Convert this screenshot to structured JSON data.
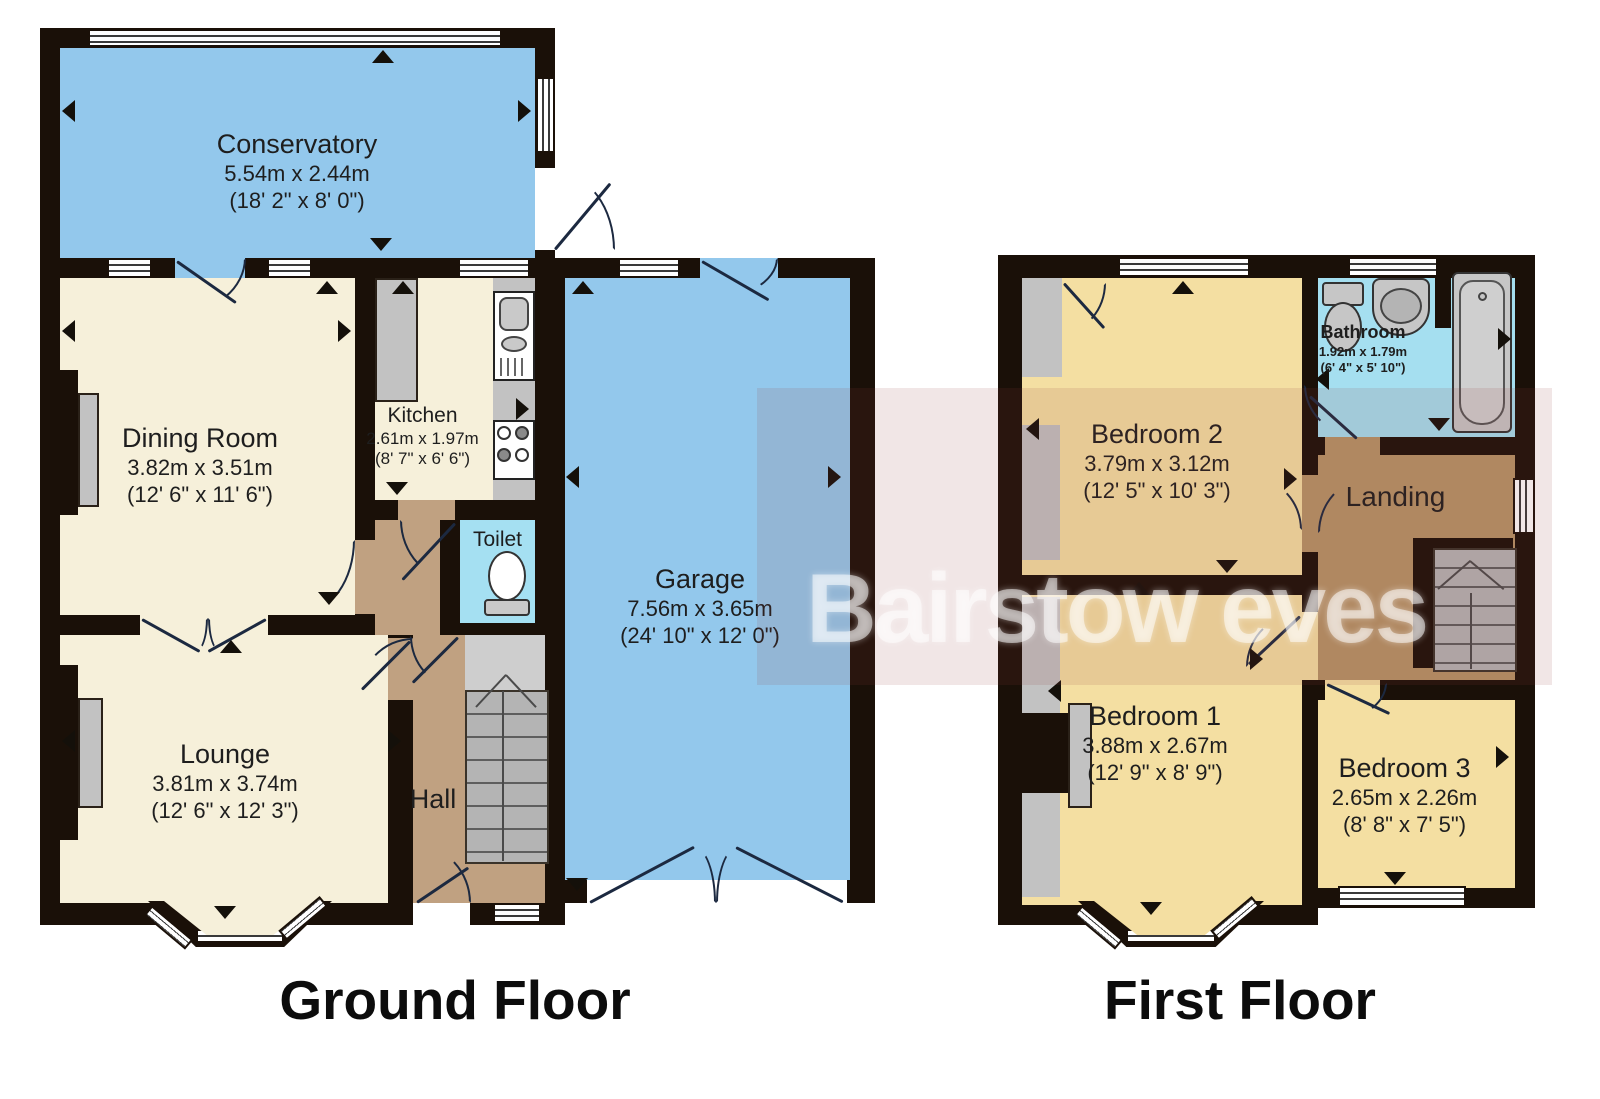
{
  "titles": {
    "ground": "Ground Floor",
    "first": "First Floor"
  },
  "watermark": {
    "text": "Bairstow eves"
  },
  "rooms": {
    "conservatory": {
      "name": "Conservatory",
      "metric": "5.54m x 2.44m",
      "imperial": "(18' 2\" x 8' 0\")"
    },
    "dining": {
      "name": "Dining Room",
      "metric": "3.82m x 3.51m",
      "imperial": "(12' 6\" x 11' 6\")"
    },
    "kitchen": {
      "name": "Kitchen",
      "metric": "2.61m x 1.97m",
      "imperial": "(8' 7\" x 6' 6\")"
    },
    "toilet": {
      "name": "Toilet"
    },
    "hall": {
      "name": "Hall"
    },
    "garage": {
      "name": "Garage",
      "metric": "7.56m x 3.65m",
      "imperial": "(24' 10\" x 12' 0\")"
    },
    "lounge": {
      "name": "Lounge",
      "metric": "3.81m x 3.74m",
      "imperial": "(12' 6\" x 12' 3\")"
    },
    "bedroom2": {
      "name": "Bedroom 2",
      "metric": "3.79m x 3.12m",
      "imperial": "(12' 5\" x 10' 3\")"
    },
    "bathroom": {
      "name": "Bathroom",
      "metric": "1.92m x 1.79m",
      "imperial": "(6' 4\" x 5' 10\")"
    },
    "landing": {
      "name": "Landing"
    },
    "bedroom1": {
      "name": "Bedroom 1",
      "metric": "3.88m x 2.67m",
      "imperial": "(12' 9\" x 8' 9\")"
    },
    "bedroom3": {
      "name": "Bedroom 3",
      "metric": "2.65m x 2.26m",
      "imperial": "(8' 8\" x 7' 5\")"
    }
  },
  "colors": {
    "wall": "#1a1008",
    "blue_room": "#93c8ec",
    "cream_room": "#f6f0da",
    "wc_cyan": "#a5e0f2",
    "hall_brown": "#c0a181",
    "landing_brown": "#b59467",
    "bedroom_yellow": "#f4dfa2",
    "stairs_gray": "#b4b4b4",
    "watermark_tint": "rgba(150,58,64,0.13)"
  }
}
